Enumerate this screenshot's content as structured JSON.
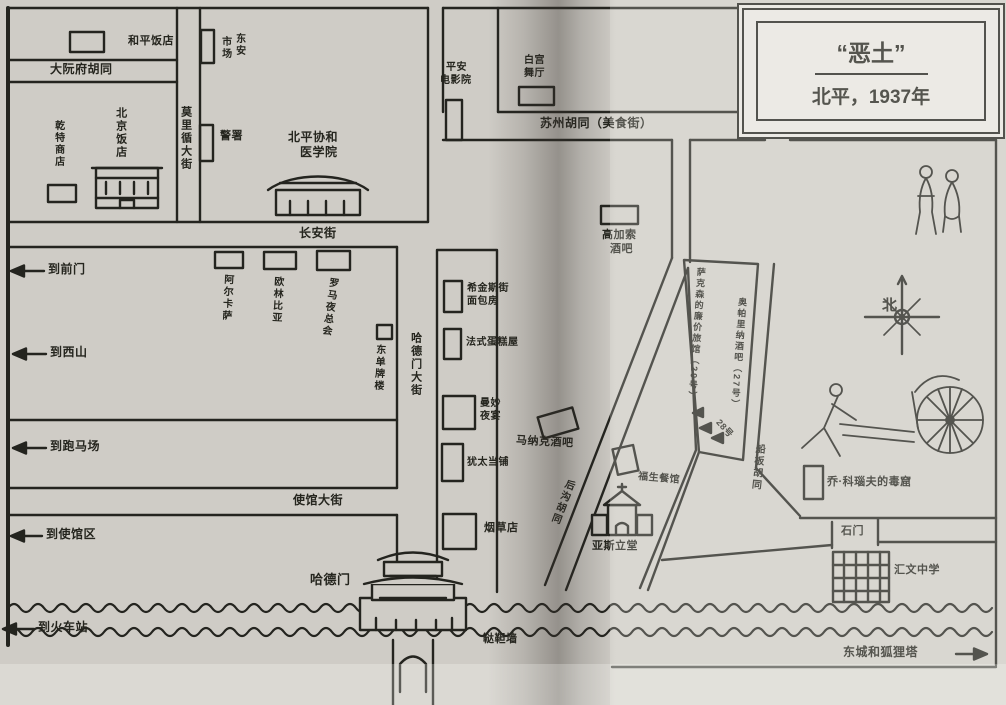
{
  "title": {
    "name": "“恶土”",
    "subtitle": "北平，1937年"
  },
  "compass": {
    "north_label": "北"
  },
  "streets": {
    "daruanfu": "大阮府胡同",
    "morrison": "莫里循大街",
    "changan": "长安街",
    "hademen_st": "哈德门大街",
    "suzhou": "苏州胡同（美食街）",
    "legation": "使馆大街",
    "hougou": "后沟胡同",
    "chuanban": "船板胡同",
    "tartar_wall": "鞑靼墙",
    "shimen": "石门"
  },
  "places": {
    "heping": "和平饭店",
    "dongan_l1": "东安",
    "dongan_l2": "市场",
    "jingshu": "警署",
    "xiehe_l1": "北平协和",
    "xiehe_l2": "医学院",
    "beijing_hotel": "北京饭店",
    "qiante": "乾特商店",
    "aerkasa": "阿尔卡萨",
    "oulinbiya": "欧林比亚",
    "luoma": "罗马夜总会",
    "dongdan": "东单牌楼",
    "pingan_l1": "平安",
    "pingan_l2": "电影院",
    "baigong_l1": "白宫",
    "baigong_l2": "舞厅",
    "gaojiasuo_l1": "高加索",
    "gaojiasuo_l2": "酒吧",
    "xijinsi_l1": "希金斯街",
    "xijinsi_l2": "面包房",
    "fashi": "法式蛋糕屋",
    "manmiao_l1": "曼妙",
    "manmiao_l2": "夜宴",
    "youtai": "犹太当铺",
    "yancaodian": "烟草店",
    "managke": "马纳克酒吧",
    "sakesen": "萨克森的廉价旅馆（29号）",
    "aopalina": "奥帕里纳酒吧（27号）",
    "no28": "28号",
    "fusheng": "福生餐馆",
    "yasili": "亚斯立堂",
    "hademen_gate": "哈德门",
    "qiao_knauf": "乔·科瑙夫的毒窟",
    "huiwen": "汇文中学"
  },
  "directions": {
    "qianmen": "到前门",
    "xishan": "到西山",
    "paomachang": "到跑马场",
    "shiguanqu": "到使馆区",
    "huochezhan": "到火车站",
    "foxtower": "东城和狐狸塔"
  }
}
